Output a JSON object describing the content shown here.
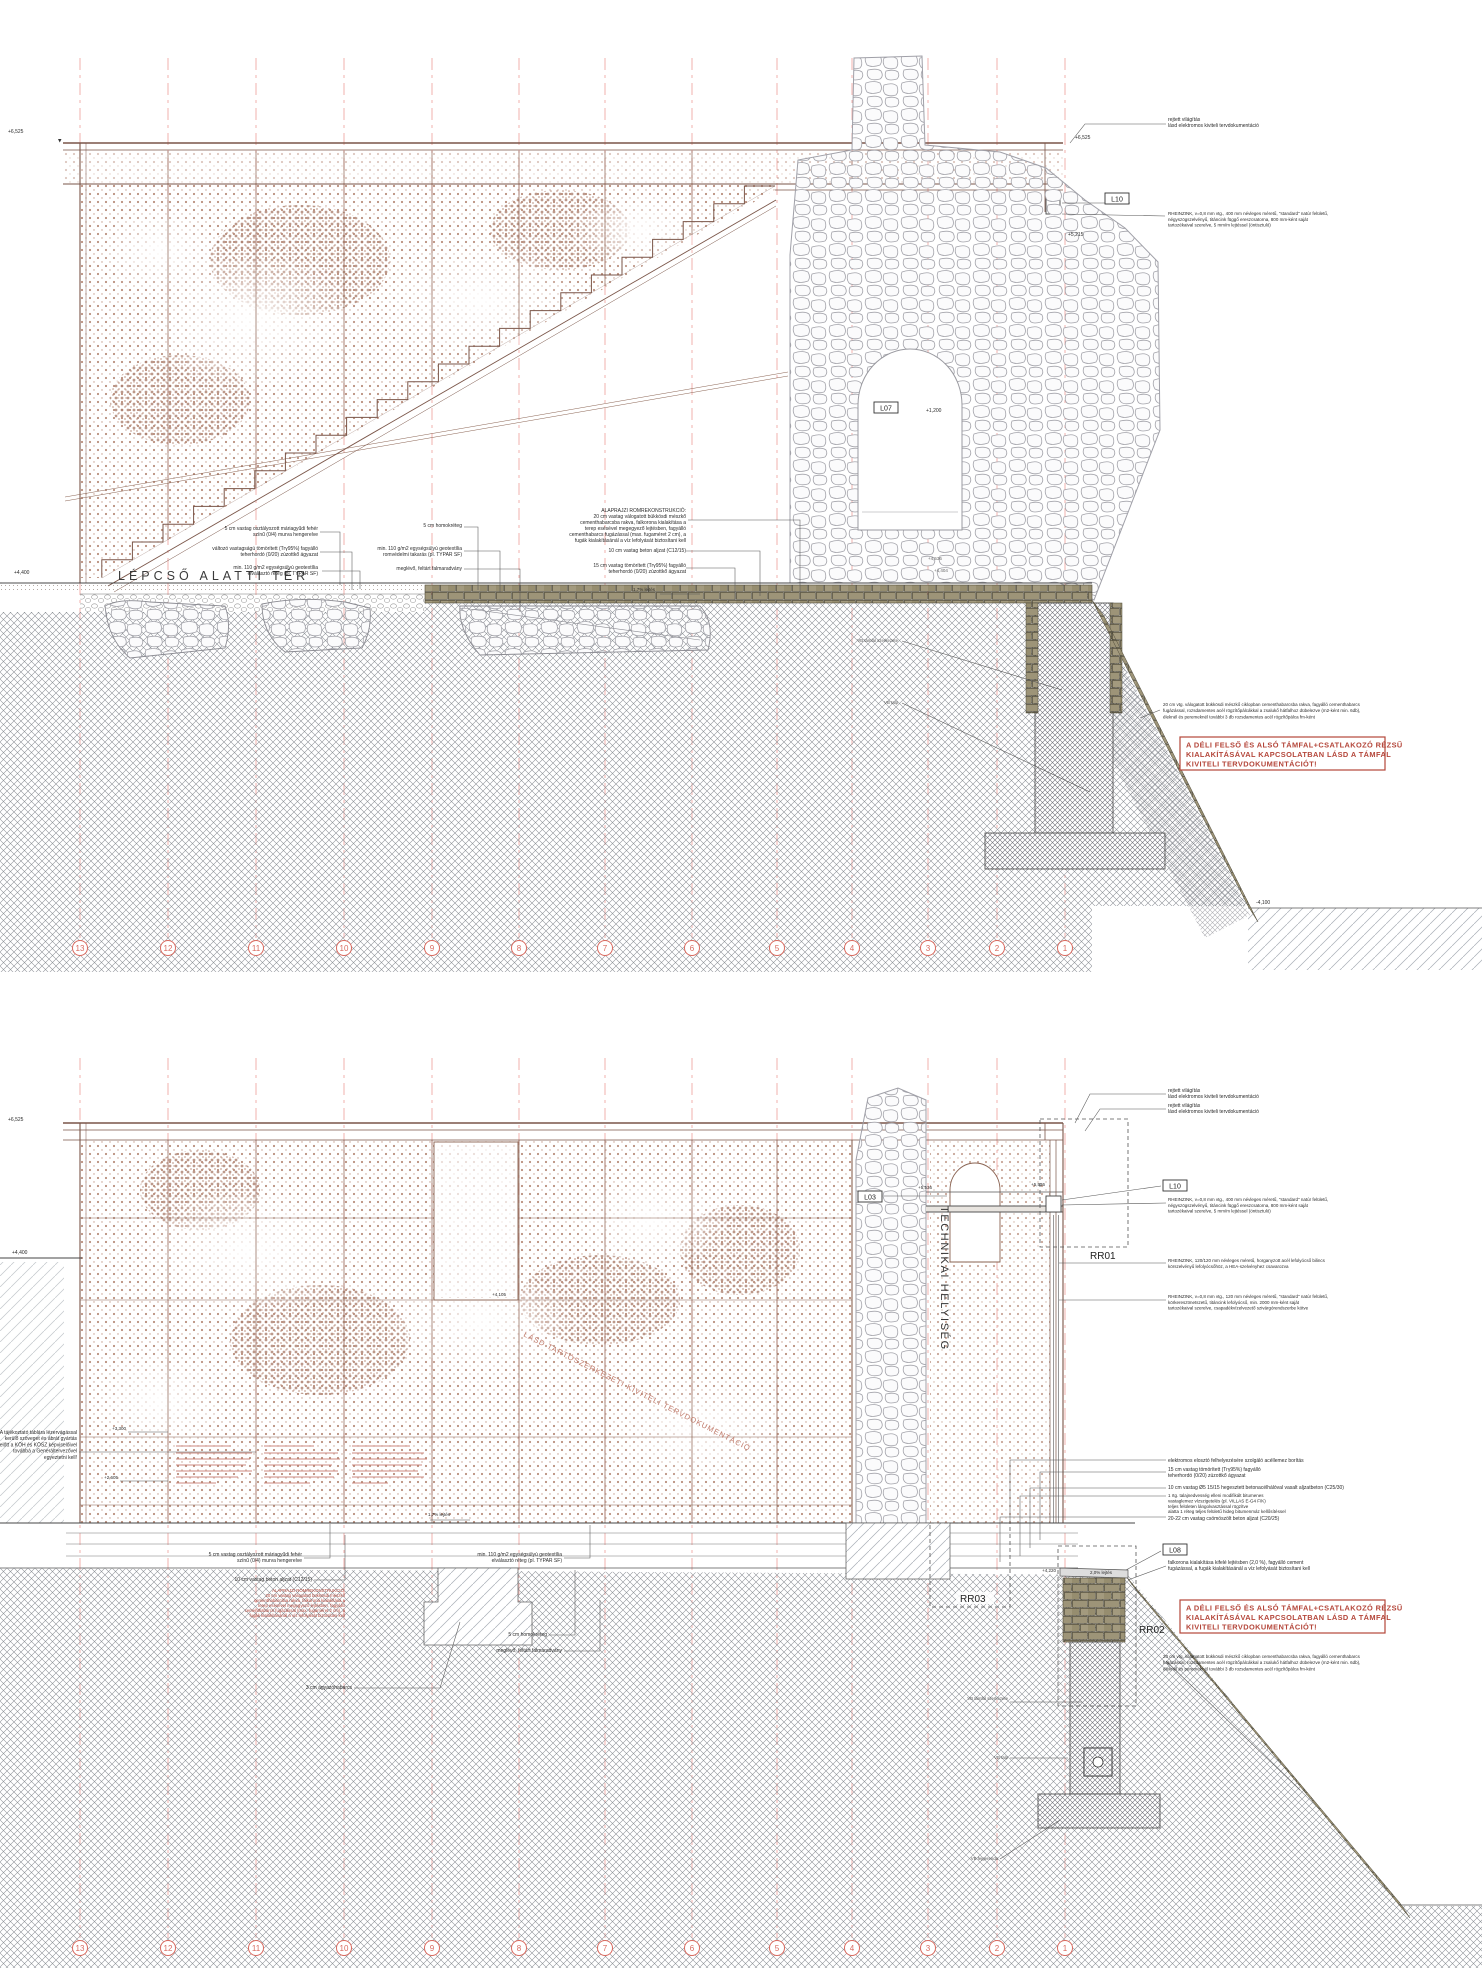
{
  "sh": {
    "grid": [
      "13",
      "12",
      "11",
      "10",
      "9",
      "8",
      "7",
      "6",
      "5",
      "4",
      "3",
      "2",
      "1"
    ],
    "rejt": [
      "rejtett világítás",
      "lásd elektromos kiviteli tervdokumentáció"
    ],
    "rz": [
      "RHEINZINK, v=0,8 mm vtg., 400 mm névleges méretű, \"standard\" natúr felületű,",
      "négyszögszelvényű, titáncink függő ereszcsatorna, 800 mm-ként saját",
      "tartozékaival szerelve, 5 mm/m lejtéssel (öntisztuló)"
    ],
    "bil": [
      "RHEINZINK, 120/120 mm névleges méretű, horganyzott acél lefolyócső bilincs",
      "körszelvényű lefolyócsőhöz, a HEA-szelvényhez csavarozva"
    ],
    "lef": [
      "RHEINZINK, v=0,8 mm vtg., 120 mm névleges méretű, \"standard\" natúr felületű,",
      "körkeresztmetszetű, titáncink lefolyócső, min. 2000 mm-ként saját",
      "tartozékaival szerelve, csapadékvízelvezető szivárgórendszerbe kötve"
    ],
    "alap": [
      "ALAPRAJZI ROMREKONSTRUKCIÓ:",
      "20 cm vastag válogatott bükkösdi mészkő",
      "cementhabarcsba rakva, falkorona kialakítása a",
      "terep esésével megegyező lejtésben, fagyálló",
      "cementhabarcs fugázással (max. fugaméret 2 cm), a",
      "fugák kialakításánál a víz lefolyását biztosítani kell"
    ],
    "beton": "10 cm vastag beton aljzat (C12/15)",
    "zuz": [
      "15 cm vastag tömörített (Trγ95%) fagyálló",
      "teherhordó (0/20) zúzottkő ágyazat"
    ],
    "murva": [
      "5 cm vastag osztályozott máriagyűdi fehér",
      "színű (0/4) murva hengerelve"
    ],
    "valt": [
      "változó vastagságú tömörített (Trγ95%) fagyálló",
      "teherhordó (0/20) zúzottkő ágyazat"
    ],
    "geoelv": [
      "min. 110 g/m2 egységsúlyú geotextília",
      "elválasztó réteg (pl. TYPAR SF)"
    ],
    "georom": [
      "min. 110 g/m2 egységsúlyú geotextília",
      "romvédelmi takarás (pl. TYPAR SF)"
    ],
    "megl": "meglévő, feltárt falmaradvány",
    "homok": "5 cm homokréteg",
    "agyazo": "3 cm ágyazóhabarcs",
    "cik": [
      "20 cm vtg. válogatott bükkösdi mészkő ciklopban cementhabarcsba rakva, fagyálló cementhabarcs",
      "fugázással, rozsdamentes acél rögzítőpálcákkal a zsalukő hátfalhoz dübelezve (m2-ként min. 6db),",
      "éleknél és peremeknél további 3 db rozsdamentes acél rögzítőpálca fm-ként"
    ],
    "warn": [
      "A DÉLI FELSŐ ÉS ALSÓ TÁMFAL+CSATLAKOZÓ RÉZSŰ",
      "KIALAKÍTÁSÁVAL KAPCSOLATBAN LÁSD A TÁMFAL",
      "KIVITELI TERVDOKUMENTÁCIÓT!"
    ],
    "elektr": "elektromos elosztó felhelyezésére szolgáló acéllemez borítás",
    "vasalt": "10 cm vastag Ø5 15/15 hegesztett betonacélhálóval vasalt aljzatbeton (C25/30)",
    "szig": [
      "1 rtg. talajnedvesség elleni modifikált bitumenes",
      "vastaglemez vízszigetelés (pl. VILLAS E-G4 F/K)",
      "teljes felületen lángolvasztással rögzítve",
      "alatta 1 réteg teljes felületű hideg bitumenmáz kellősítéssel"
    ],
    "csomo": "20-22 cm vastag csömöszölt beton aljzat (C20/25)",
    "falk": [
      "falkorona kialakítása kifelé lejtésben (2,0 %), fagyálló cement",
      "fugázással, a fugák kialakításánál a víz lefolyását biztosítani kell"
    ],
    "tabla": [
      "A tájékoztató táblára lézervágással",
      "kerülő szöveget és ábrát gyártás",
      "előtt a KÖH és KÖSZ képviselőivel",
      "továbbá a Generáltervezővel",
      "egyeztetni kell!"
    ],
    "diag": "LÁSD TARTÓSZERKEZETI KIVITELI TERVDOKUMENTÁCIÓ",
    "tech": "TECHNIKAI HELYISÉG",
    "lepcso": "LÉPCSŐ ALATTI TÉR",
    "vb1": "VB támfal szerkezete",
    "vb2": "VB talp",
    "vb3": "VB fejgerenda",
    "lab": {
      "l10": "L10",
      "l07": "L07",
      "l03": "L03",
      "l08": "L08",
      "rr01": "RR01",
      "rr02": "RR02",
      "rr03": "RR03"
    },
    "elev": {
      "e6525": "+6,525",
      "e5215": "+5,215",
      "e5536": "+5,536",
      "e4400": "+4,400",
      "e4105": "+4,105",
      "e1200": "+1,200",
      "e4536": "+4,536",
      "e4404": "+4,404",
      "e3300": "+3,300",
      "e2605": "+2,605",
      "e4220": "+4,220",
      "em4100": "-4,100"
    },
    "lejtes17": "1,7% lejtés",
    "lejtes20": "2,0% lejtés"
  },
  "colors": {
    "accent_red": "#d96a5f",
    "grid_dash": "#ef9a95",
    "wall_dot": "#b98e7d",
    "panel_line": "#8a6352",
    "warn": "#b4463a",
    "stone": "#a0a0a8",
    "block_fill": "#9d9478",
    "hatch": "#8b9096"
  }
}
